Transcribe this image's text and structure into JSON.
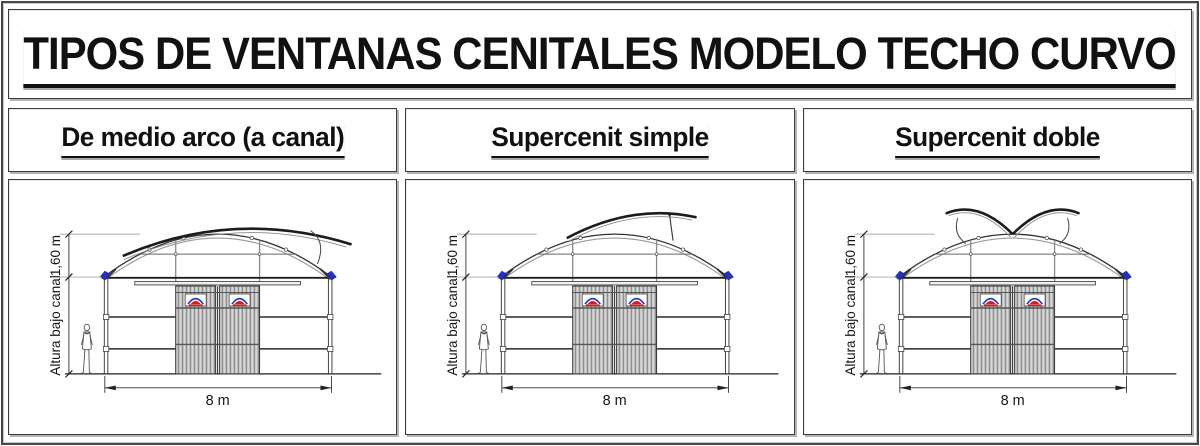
{
  "sheet_title": "TIPOS DE VENTANAS CENITALES MODELO TECHO CURVO",
  "panels": [
    {
      "title": "De medio arco (a canal)",
      "labels": {
        "roof_rise": "1,60 m",
        "under_gutter": "Altura bajo canal",
        "span": "8 m"
      }
    },
    {
      "title": "Supercenit simple",
      "labels": {
        "roof_rise": "1,60 m",
        "under_gutter": "Altura bajo canal",
        "span": "8 m"
      }
    },
    {
      "title": "Supercenit doble",
      "labels": {
        "roof_rise": "1,60 m",
        "under_gutter": "Altura bajo canal",
        "span": "8 m"
      }
    }
  ],
  "colors": {
    "gutter_blue": "#1f2fd6",
    "logo_blue": "#1e3fbe",
    "logo_red": "#cc2020",
    "line_dark": "#1c1c1c",
    "line_gray": "#8a8a8a"
  }
}
